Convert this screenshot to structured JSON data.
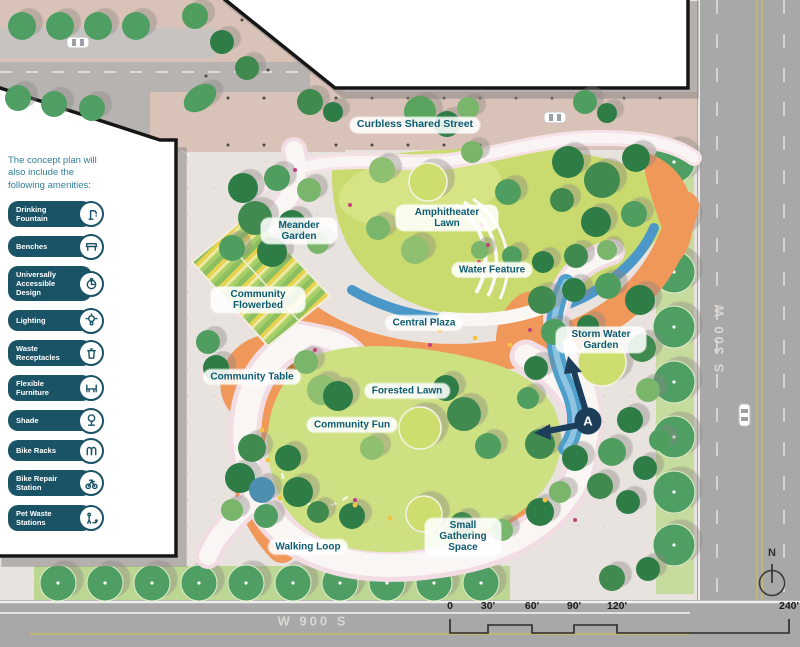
{
  "title": "Park concept plan",
  "colors": {
    "legend_teal": "#1B5366",
    "label_teal": "#0D5B72",
    "orange": "#F0975A",
    "water_blue": "#4A97C8",
    "lawn_green": "#C9DA6E",
    "tree_green": "#4F9E63",
    "marker_navy": "#1D3E5A",
    "road_gray": "#A8A8A8",
    "street_tan": "#D9C2B7"
  },
  "legend": {
    "heading": "The concept plan will also include the following amenities:",
    "items": [
      {
        "label": "Drinking Fountain",
        "icon": "drinking-fountain-icon"
      },
      {
        "label": "Benches",
        "icon": "bench-icon"
      },
      {
        "label": "Universally Accessible Design",
        "icon": "accessible-icon"
      },
      {
        "label": "Lighting",
        "icon": "lighting-icon"
      },
      {
        "label": "Waste Receptacles",
        "icon": "waste-icon"
      },
      {
        "label": "Flexible Furniture",
        "icon": "furniture-icon"
      },
      {
        "label": "Shade",
        "icon": "shade-tree-icon"
      },
      {
        "label": "Bike Racks",
        "icon": "bike-rack-icon"
      },
      {
        "label": "Bike Repair Station",
        "icon": "bike-repair-icon"
      },
      {
        "label": "Pet Waste Stations",
        "icon": "pet-waste-icon"
      }
    ]
  },
  "map": {
    "area_labels": {
      "curbless_shared_street": "Curbless Shared Street",
      "meander_garden": "Meander Garden",
      "amphitheater_lawn": "Amphitheater Lawn",
      "water_feature": "Water Feature",
      "community_flowerbed": "Community Flowerbed",
      "central_plaza": "Central Plaza",
      "community_table": "Community Table",
      "forested_lawn": "Forested Lawn",
      "community_fun": "Community Fun",
      "storm_water_garden": "Storm Water Garden",
      "walking_loop": "Walking Loop",
      "small_gathering_space": "Small Gathering Space"
    },
    "streets": {
      "east": "S 300 W",
      "south": "W 900 S"
    },
    "marker": {
      "label": "A"
    },
    "compass": {
      "north_label": "N"
    },
    "scale_bar": {
      "ticks": [
        "0",
        "30'",
        "60'",
        "90'",
        "120'",
        "240'"
      ]
    }
  }
}
